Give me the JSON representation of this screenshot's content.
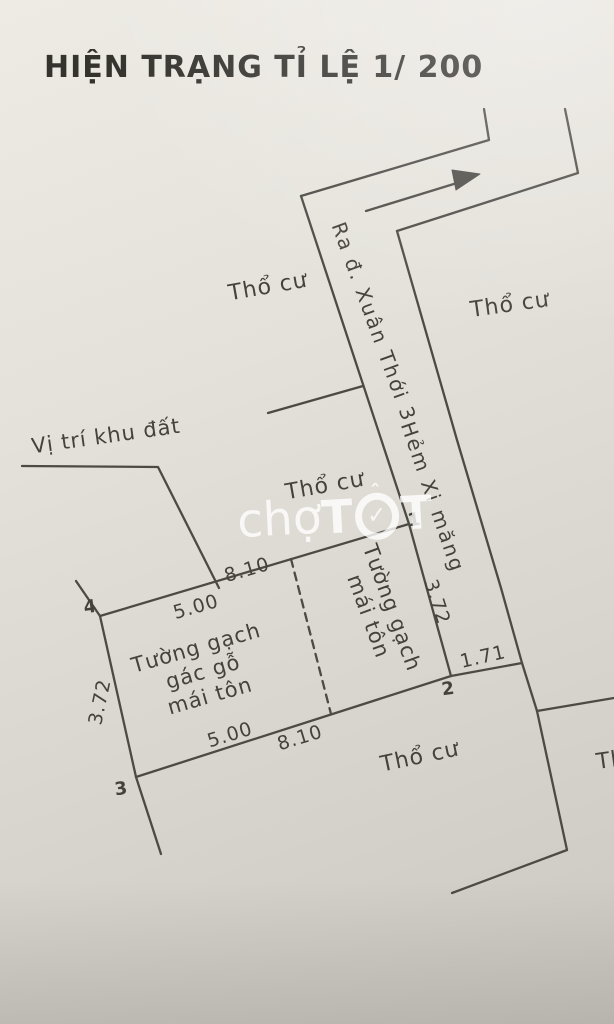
{
  "title": "HIỆN TRẠNG TỈ LỆ 1/ 200",
  "watermark": {
    "prefix": "chợ",
    "t1": "T",
    "check": "✓",
    "circumflex": "ˆ",
    "t2": "T"
  },
  "location_note": "Vị trí khu đất",
  "roads": {
    "exit_road": "Ra đ. Xuân Thới 3",
    "alley_name": "Hẻm Xi măng"
  },
  "land_labels": {
    "top_left": "Thổ cư",
    "top_right": "Thổ cư",
    "center": "Thổ cư",
    "bottom": "Thổ cư",
    "right_edge": "Thổ cư"
  },
  "plot": {
    "corner_labels": {
      "c1": "1",
      "c2": "2",
      "c3": "3",
      "c4": "4"
    },
    "dimensions": {
      "top_total": "8.10",
      "top_segment": "5.00",
      "left_side": "3.72",
      "right_side": "3.72",
      "bottom_total": "8.10",
      "bottom_segment": "5.00",
      "alley_frontage": "1.71"
    },
    "structures": {
      "left_room": {
        "line1": "Tường gạch",
        "line2": "gác gỗ",
        "line3": "mái tôn"
      },
      "right_room": {
        "line1": "Tường gạch",
        "line2": "mái tôn"
      }
    }
  },
  "colors": {
    "line": "#4c4a45",
    "paper": "#ddd9d2",
    "watermark": "#ffffff"
  }
}
